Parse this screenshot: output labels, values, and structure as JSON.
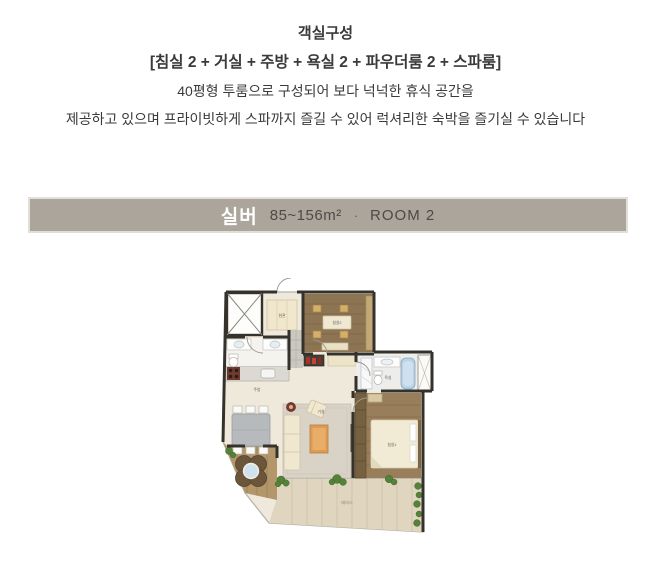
{
  "intro": {
    "title": "객실구성",
    "composition": "[침실 2 + 거실 + 주방 + 욕실 2 + 파우더룸 2 + 스파룸]",
    "desc_line1": "40평형 투룸으로 구성되어 보다 넉넉한 휴식 공간을",
    "desc_line2": "제공하고 있으며 프라이빗하게 스파까지 즐길 수 있어 럭셔리한 숙박을 즐기실 수 있습니다"
  },
  "banner": {
    "room_name": "실버",
    "area": "85~156m²",
    "separator": "·",
    "room_count": "ROOM 2",
    "bg_color": "#aba59c",
    "name_color": "#ffffff",
    "info_color": "#4c4a47"
  },
  "floorplan": {
    "labels": {
      "entrance": "현관",
      "bedroom2": "침실2",
      "bathroom": "욕실",
      "bedroom1": "침실1",
      "kitchen": "주방",
      "living": "거실",
      "terrace": "테라스"
    },
    "colors": {
      "wall": "#35322c",
      "floor": "#efe9db",
      "wood": "#8d7453",
      "terrace": "#e0d6bf",
      "spa_water": "#cfe3ee",
      "tub": "#b9d2e6",
      "greenery": "#55823a"
    }
  }
}
